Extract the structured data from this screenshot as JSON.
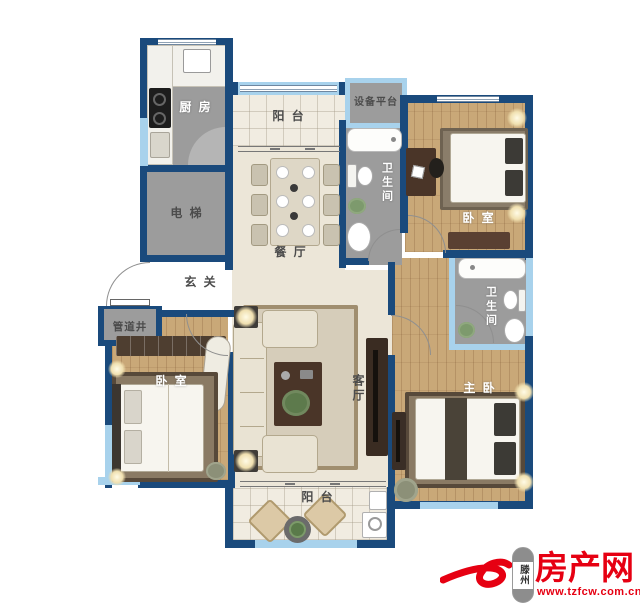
{
  "rooms": {
    "kitchen": {
      "label": "厨 房"
    },
    "elevator": {
      "label": "电 梯"
    },
    "balcony_top": {
      "label": "阳 台"
    },
    "equipment_platform": {
      "label": "设备平台"
    },
    "bathroom_north": {
      "label": "卫生间"
    },
    "bedroom_northeast": {
      "label": "卧 室"
    },
    "dining": {
      "label": "餐 厅"
    },
    "foyer": {
      "label": "玄 关"
    },
    "pipe_shaft": {
      "label": "管道井"
    },
    "bedroom_west": {
      "label": "卧 室"
    },
    "living": {
      "label": "客厅"
    },
    "bathroom_east": {
      "label": "卫生间"
    },
    "master_bedroom": {
      "label": "主 卧"
    },
    "balcony_bottom": {
      "label": "阳 台"
    }
  },
  "watermark": {
    "badge_text": "滕州",
    "site_name": "房产网",
    "url": "www.tzfcw.com.cn",
    "brand_color": "#e60012"
  },
  "colors": {
    "wall": "#1a4a7c",
    "window": "#a8d2ec",
    "service_room": "#9c9c9c",
    "wood_floor": "#c9a878",
    "tile_floor": "#ece6d8"
  }
}
